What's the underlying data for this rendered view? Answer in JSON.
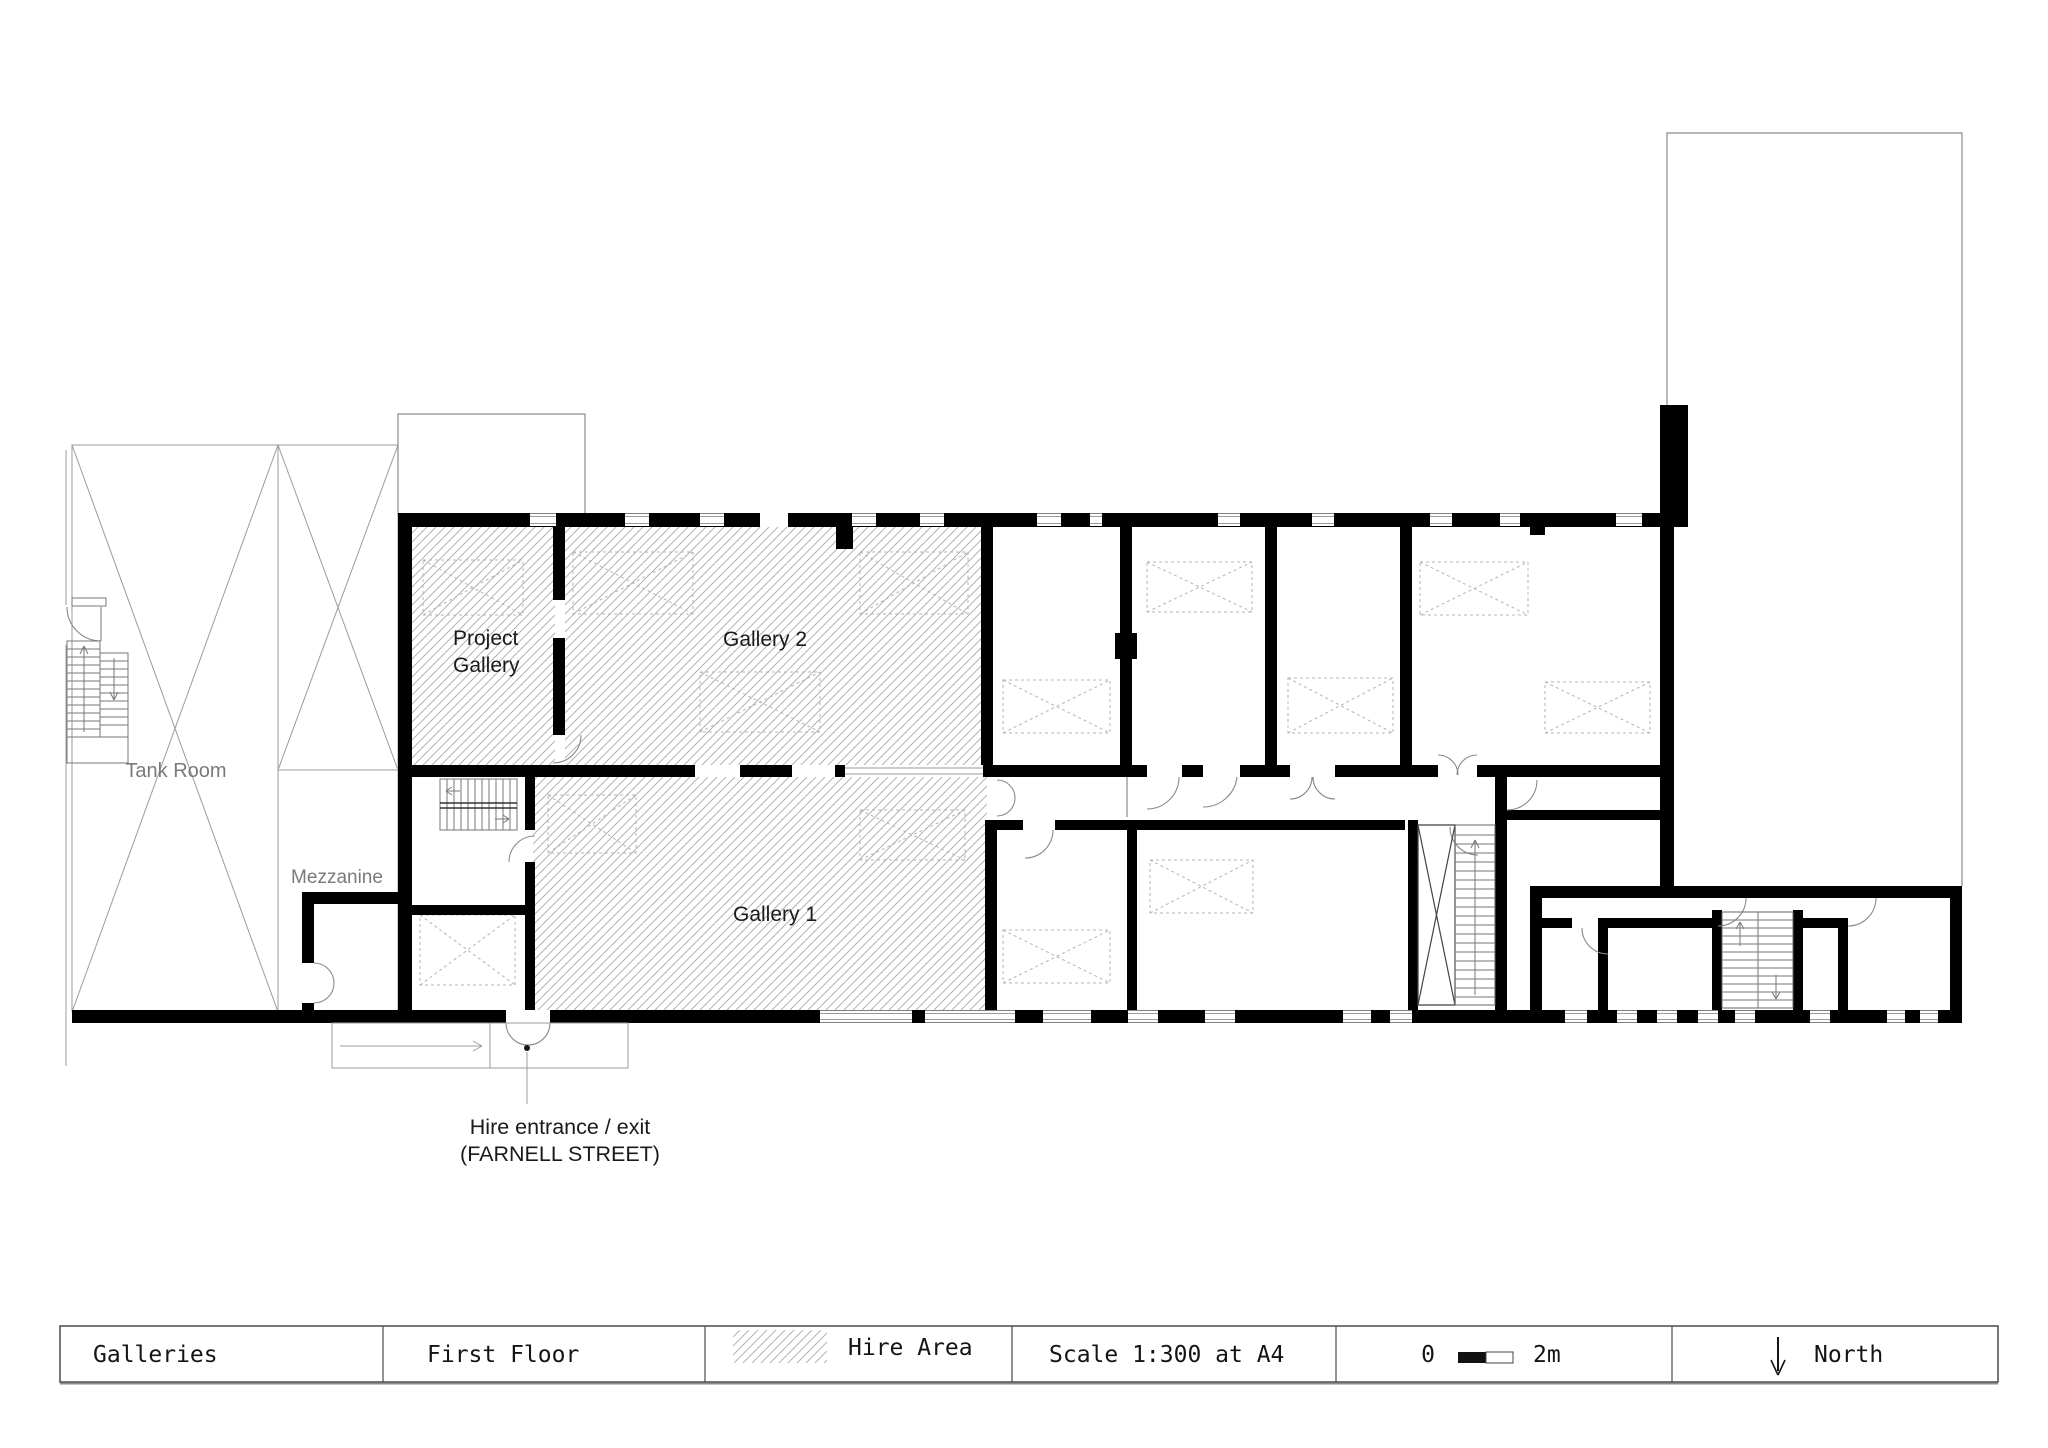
{
  "plan": {
    "rooms": {
      "tank_room": "Tank Room",
      "mezzanine": "Mezzanine",
      "project_gallery_line1": "Project",
      "project_gallery_line2": "Gallery",
      "gallery_2": "Gallery 2",
      "gallery_1": "Gallery 1"
    },
    "annotations": {
      "entrance_line1": "Hire entrance / exit",
      "entrance_line2": "(FARNELL STREET)"
    }
  },
  "legend": {
    "sheet": "Galleries",
    "floor": "First Floor",
    "hire_area": "Hire Area",
    "scale": "Scale 1:300 at A4",
    "scalebar_zero": "0",
    "scalebar_max": "2m",
    "north": "North"
  },
  "colors": {
    "wall": "#000000",
    "hatch_line": "#a9a9a9",
    "thin_outline": "#9b9b9b",
    "room_text_gray": "#7a7a7a",
    "text_dark": "#1a1a1a"
  }
}
